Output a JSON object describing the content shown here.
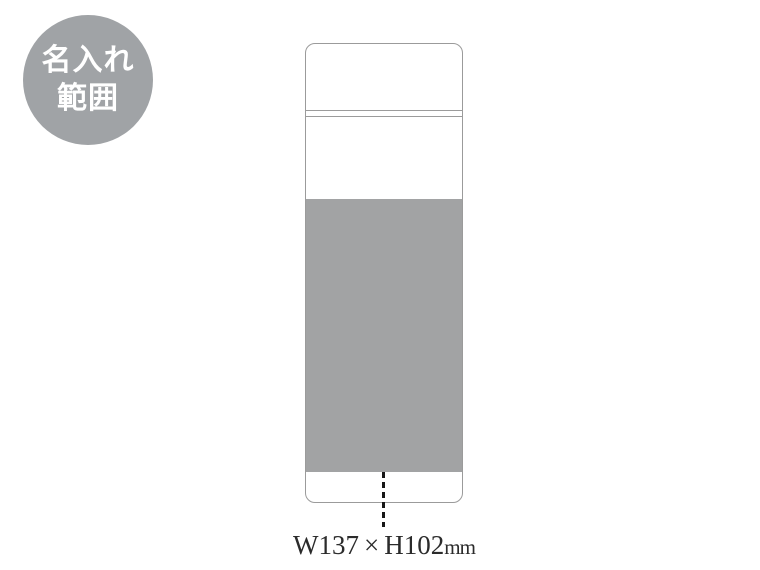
{
  "badge": {
    "lines": [
      "名入れ",
      "範囲"
    ],
    "bg_color": "#a0a3a6",
    "text_color": "#ffffff"
  },
  "bottle": {
    "outline_color": "#9b9b9b",
    "fill_color": "#ffffff"
  },
  "print_area": {
    "fill_color": "#a2a3a4"
  },
  "leader_line": {
    "color": "#161616",
    "style": "dashed"
  },
  "dimension": {
    "width_label": "W137",
    "times": "×",
    "height_label": "H102",
    "unit": "mm",
    "text_color": "#2b2b2b"
  }
}
